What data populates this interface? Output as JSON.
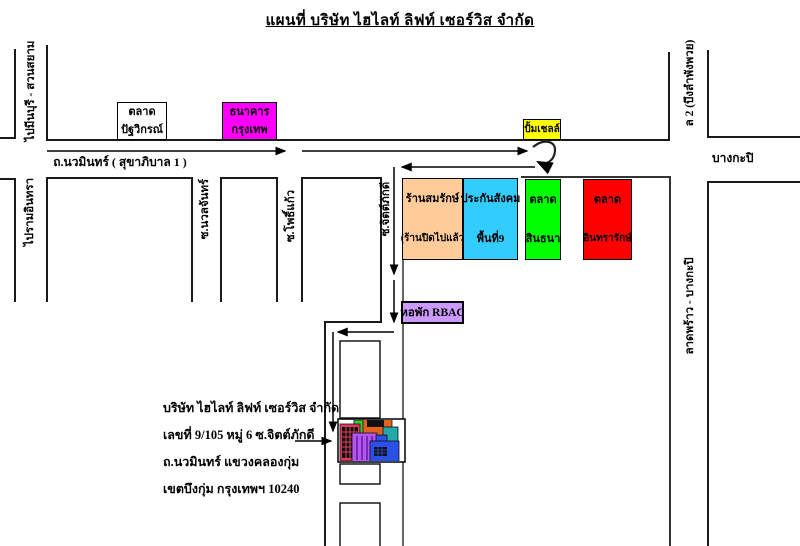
{
  "title": "แผนที่  บริษัท ไฮไลท์ ลิฟท์ เซอร์วิส  จำกัด",
  "roads": {
    "main_road_label": "ถ.นวมินทร์ ( สุขาภิบาล 1 )",
    "to_minburi": "ไปมีนบุรี - สวนสยาม",
    "to_ramindra": "ไปรามอินทรา",
    "soi_nuanchan": "ซ.นวลจันทร์",
    "soi_phokaeo": "ซ.โพธิ์แก้ว",
    "soi_chitphakdi": "ซ.จิตต์ภักดี",
    "sukhaphiban2": "ล 2 (บึงลำพังพวย)",
    "bangkapi": "บางกะปิ",
    "latphrao_bangkapi": "ลาดพร้าว - บางกะปิ"
  },
  "places": {
    "market_patthawikon": {
      "lines": [
        "ตลาด",
        "ปัฐวิกรณ์"
      ],
      "color": "#FFFFFF"
    },
    "bangkok_bank": {
      "lines": [
        "ธนาคาร",
        "กรุงเทพ"
      ],
      "color": "#FF00FF"
    },
    "shell_station": {
      "label": "ปั้มเชลล์",
      "color": "#FFFF00"
    },
    "somrak_shop": {
      "lines": [
        "ร้านสมรักษ์",
        "(ร้านปิดไปแล้ว"
      ],
      "color": "#FFCC99"
    },
    "social_security": {
      "lines": [
        "ประกันสังคม",
        "พื้นที่9"
      ],
      "color": "#33CCFF"
    },
    "sinthana_market": {
      "lines": [
        "ตลาด",
        "สินธนา"
      ],
      "color": "#00FF00"
    },
    "intrarak_market": {
      "lines": [
        "ตลาด",
        "อินทรารักษ์"
      ],
      "color": "#FF0000"
    },
    "rbac_dorm": {
      "label": "หอพัก  RBAC",
      "color": "#CC99FF"
    }
  },
  "company": {
    "address_lines": [
      "บริษัท ไฮไลท์ ลิฟท์ เซอร์วิส จำกัด",
      "เลขที่ 9/105 หมู่ 6 ซ.จิตต์ภักดี",
      "ถ.นวมินทร์ แขวงคลองกุ่ม",
      "เขตบึงกุ่ม กรุงเทพฯ 10240"
    ]
  },
  "colors": {
    "road_line": "#1a1a1a",
    "alley_line": "#666666",
    "route_arrow": "#000000"
  }
}
